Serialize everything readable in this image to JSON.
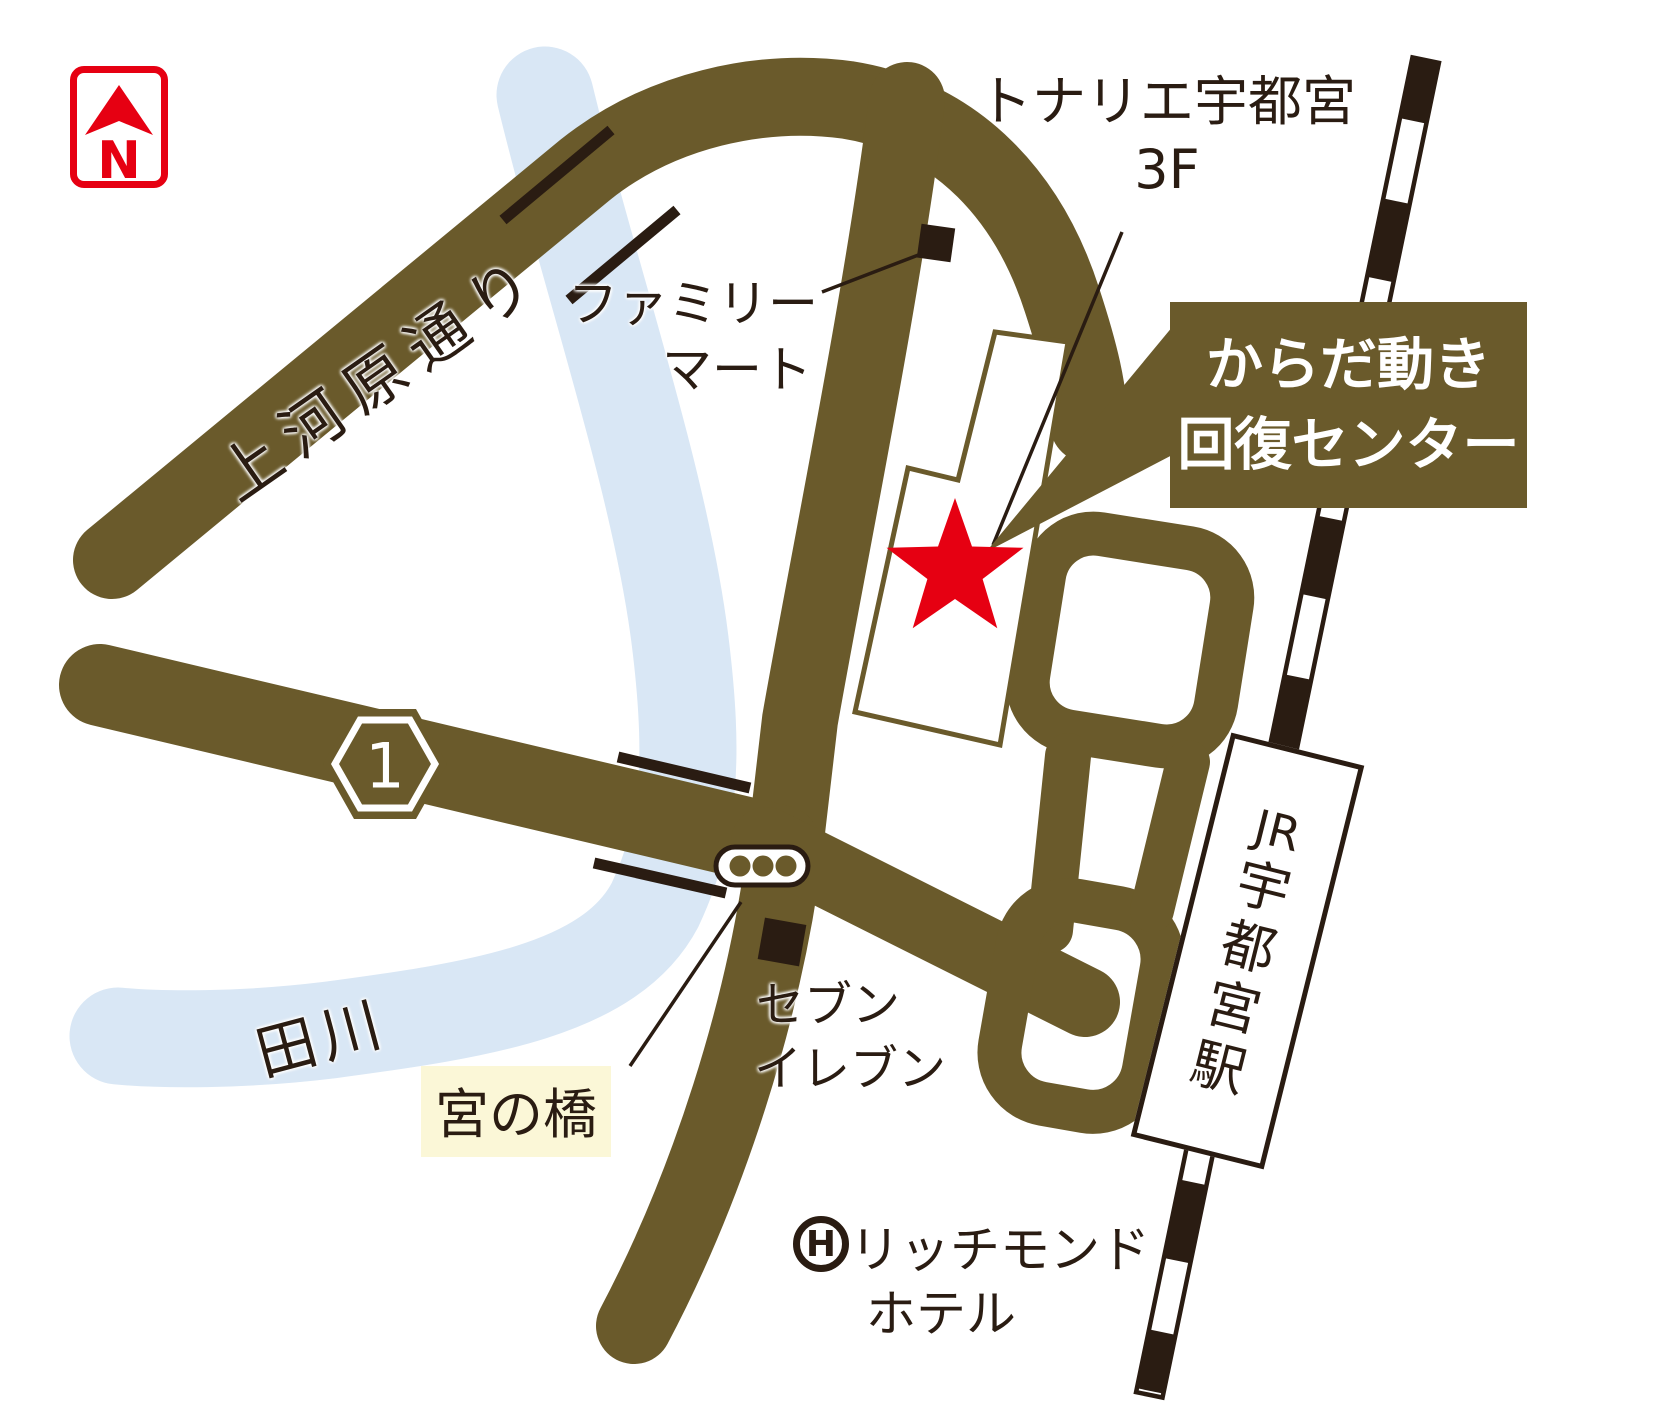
{
  "title": "からだ動き回復センター アクセスマップ（JR宇都宮駅周辺）",
  "colors": {
    "road_brown": "#6a5a2b",
    "dark_ink": "#2a1c12",
    "accent_red": "#e60012",
    "river_blue": "#d9e7f5",
    "bridge_label_bg": "#fbf7d7",
    "white": "#ffffff"
  },
  "compass": {
    "letter": "N"
  },
  "labels": {
    "street": "上河原通り",
    "familymart": [
      "ファミリー",
      "マート"
    ],
    "tonarie": "トナリエ宇都宮",
    "tonarie_floor": "3F",
    "callout": [
      "からだ動き",
      "回復センター"
    ],
    "route_number": "1",
    "river": "田川",
    "bridge": "宮の橋",
    "seveneleven": [
      "セブン",
      "イレブン"
    ],
    "hotel_mark": "H",
    "hotel": [
      "リッチモンド",
      "ホテル"
    ]
  },
  "station": {
    "label": "JR宇都宮駅",
    "chars": [
      "JR",
      "宇",
      "都",
      "宮",
      "駅"
    ]
  },
  "icons": [
    "north-compass-icon",
    "route-1-hexagon-badge",
    "traffic-light-icon",
    "convenience-store-square-marker",
    "hotel-circle-h-icon",
    "location-star",
    "railway-line",
    "bridge-tick-marks"
  ]
}
